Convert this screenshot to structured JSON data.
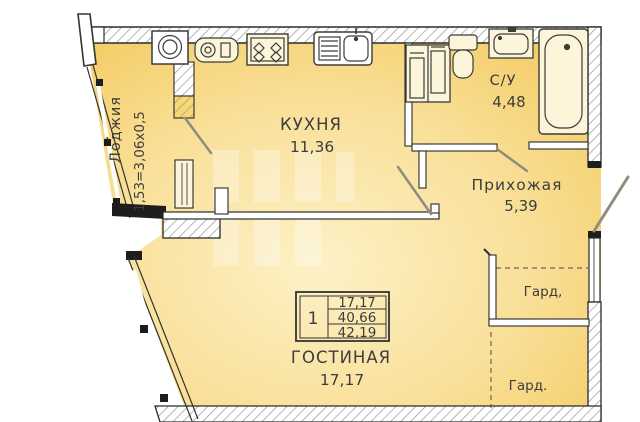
{
  "plan_title": "apartment-floor-plan",
  "rooms": {
    "loggia": {
      "label": "Лоджия",
      "dims": "1,53=3,06х0,5"
    },
    "kitchen": {
      "label": "КУХНЯ",
      "area": "11,36"
    },
    "bathroom": {
      "label": "С/У",
      "area": "4,48"
    },
    "hallway": {
      "label": "Прихожая",
      "area": "5,39"
    },
    "living": {
      "label": "ГОСТИНАЯ",
      "area": "17,17"
    },
    "wardrobe_top": {
      "label": "Гард,"
    },
    "wardrobe_bottom": {
      "label": "Гард."
    }
  },
  "stamp": {
    "rooms_count": "1",
    "row1": "17,17",
    "row2": "40,66",
    "row3": "42,19"
  },
  "colors": {
    "fill_edge": "#f3c757",
    "fill_center": "#fdf1c6",
    "wall": "#2b2b2b",
    "hatch": "#979797",
    "text": "#3d3d3d"
  }
}
